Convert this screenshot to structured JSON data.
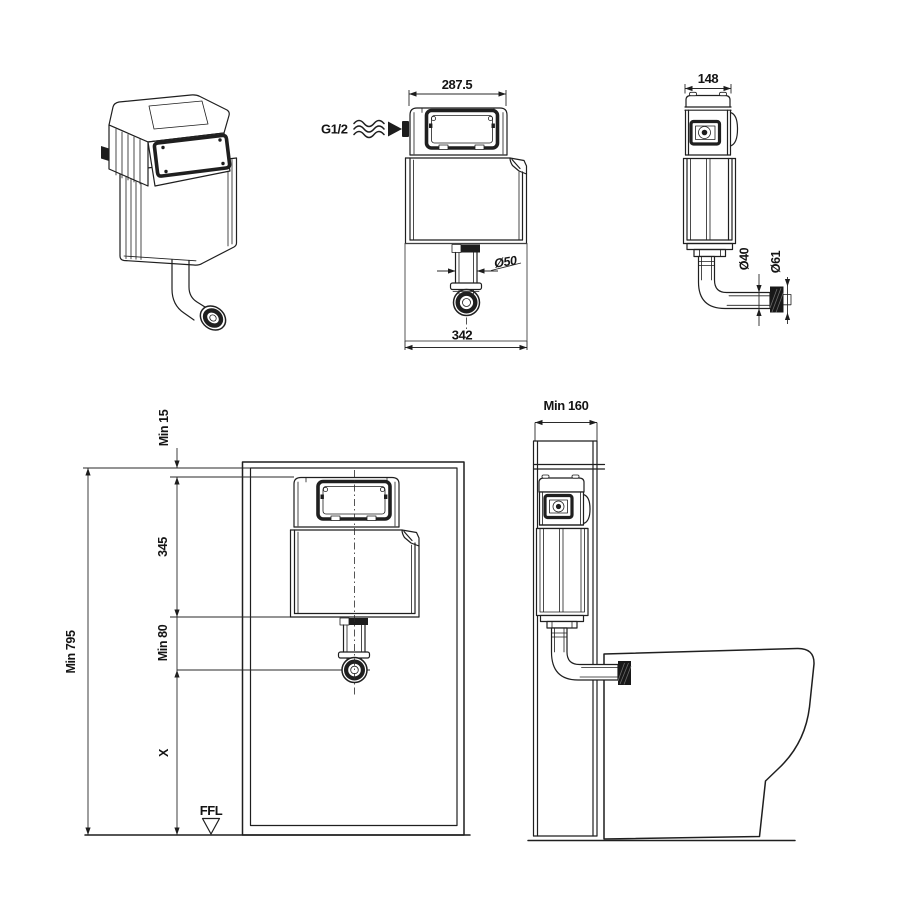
{
  "colors": {
    "line": "#1f1f1f",
    "background": "#ffffff"
  },
  "front_view": {
    "dim_width_top": "287.5",
    "dim_width_bottom": "342",
    "inlet_label": "G1/2",
    "outlet_diameter": "Ø50"
  },
  "side_view": {
    "dim_depth": "148",
    "pipe_diameter": "Ø40",
    "connector_diameter": "Ø61"
  },
  "install_front_view": {
    "dim_min_top_clearance": "Min 15",
    "dim_cistern_height": "345",
    "dim_min_outlet_height": "Min 80",
    "dim_min_overall_height": "Min 795",
    "dim_floor_offset": "X",
    "floor_level_label": "FFL"
  },
  "install_side_view": {
    "dim_min_depth": "Min 160"
  }
}
